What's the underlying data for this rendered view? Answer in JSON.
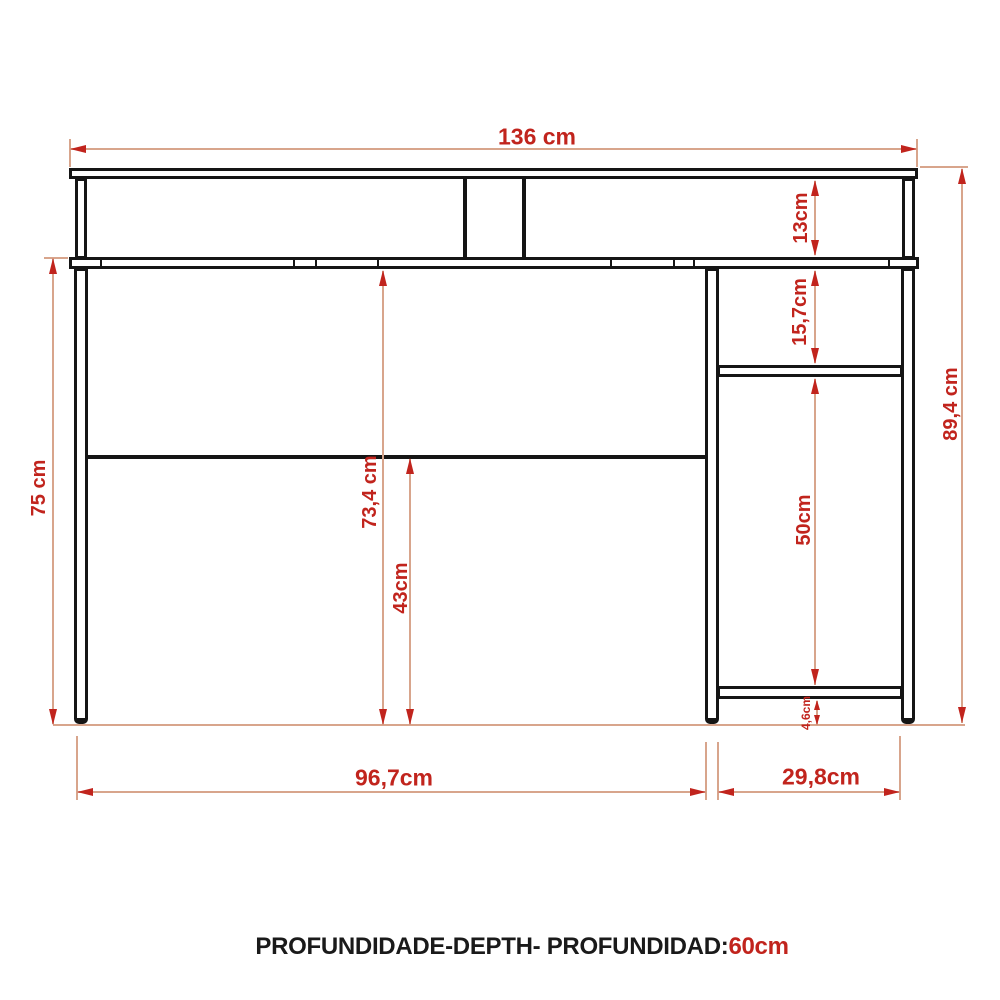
{
  "drawing": {
    "type": "furniture technical drawing - desk front elevation",
    "dimensions": {
      "top_width": "136 cm",
      "riser_height": "13cm",
      "upper_shelf_gap": "15,7cm",
      "total_height": "89,4 cm",
      "left_height": "75 cm",
      "underside_height": "73,4 cm",
      "mid_panel_height": "43cm",
      "cabinet_opening_height": "50cm",
      "foot_height": "4,6cm",
      "left_span": "96,7cm",
      "right_span": "29,8cm"
    },
    "caption": {
      "label": "PROFUNDIDADE-DEPTH- PROFUNDIDAD:",
      "value": "60cm"
    },
    "colors": {
      "dimension_accent": "#c1241d",
      "dimension_line": "#d8a58c",
      "furniture_line": "#151515",
      "background": "#ffffff"
    }
  }
}
